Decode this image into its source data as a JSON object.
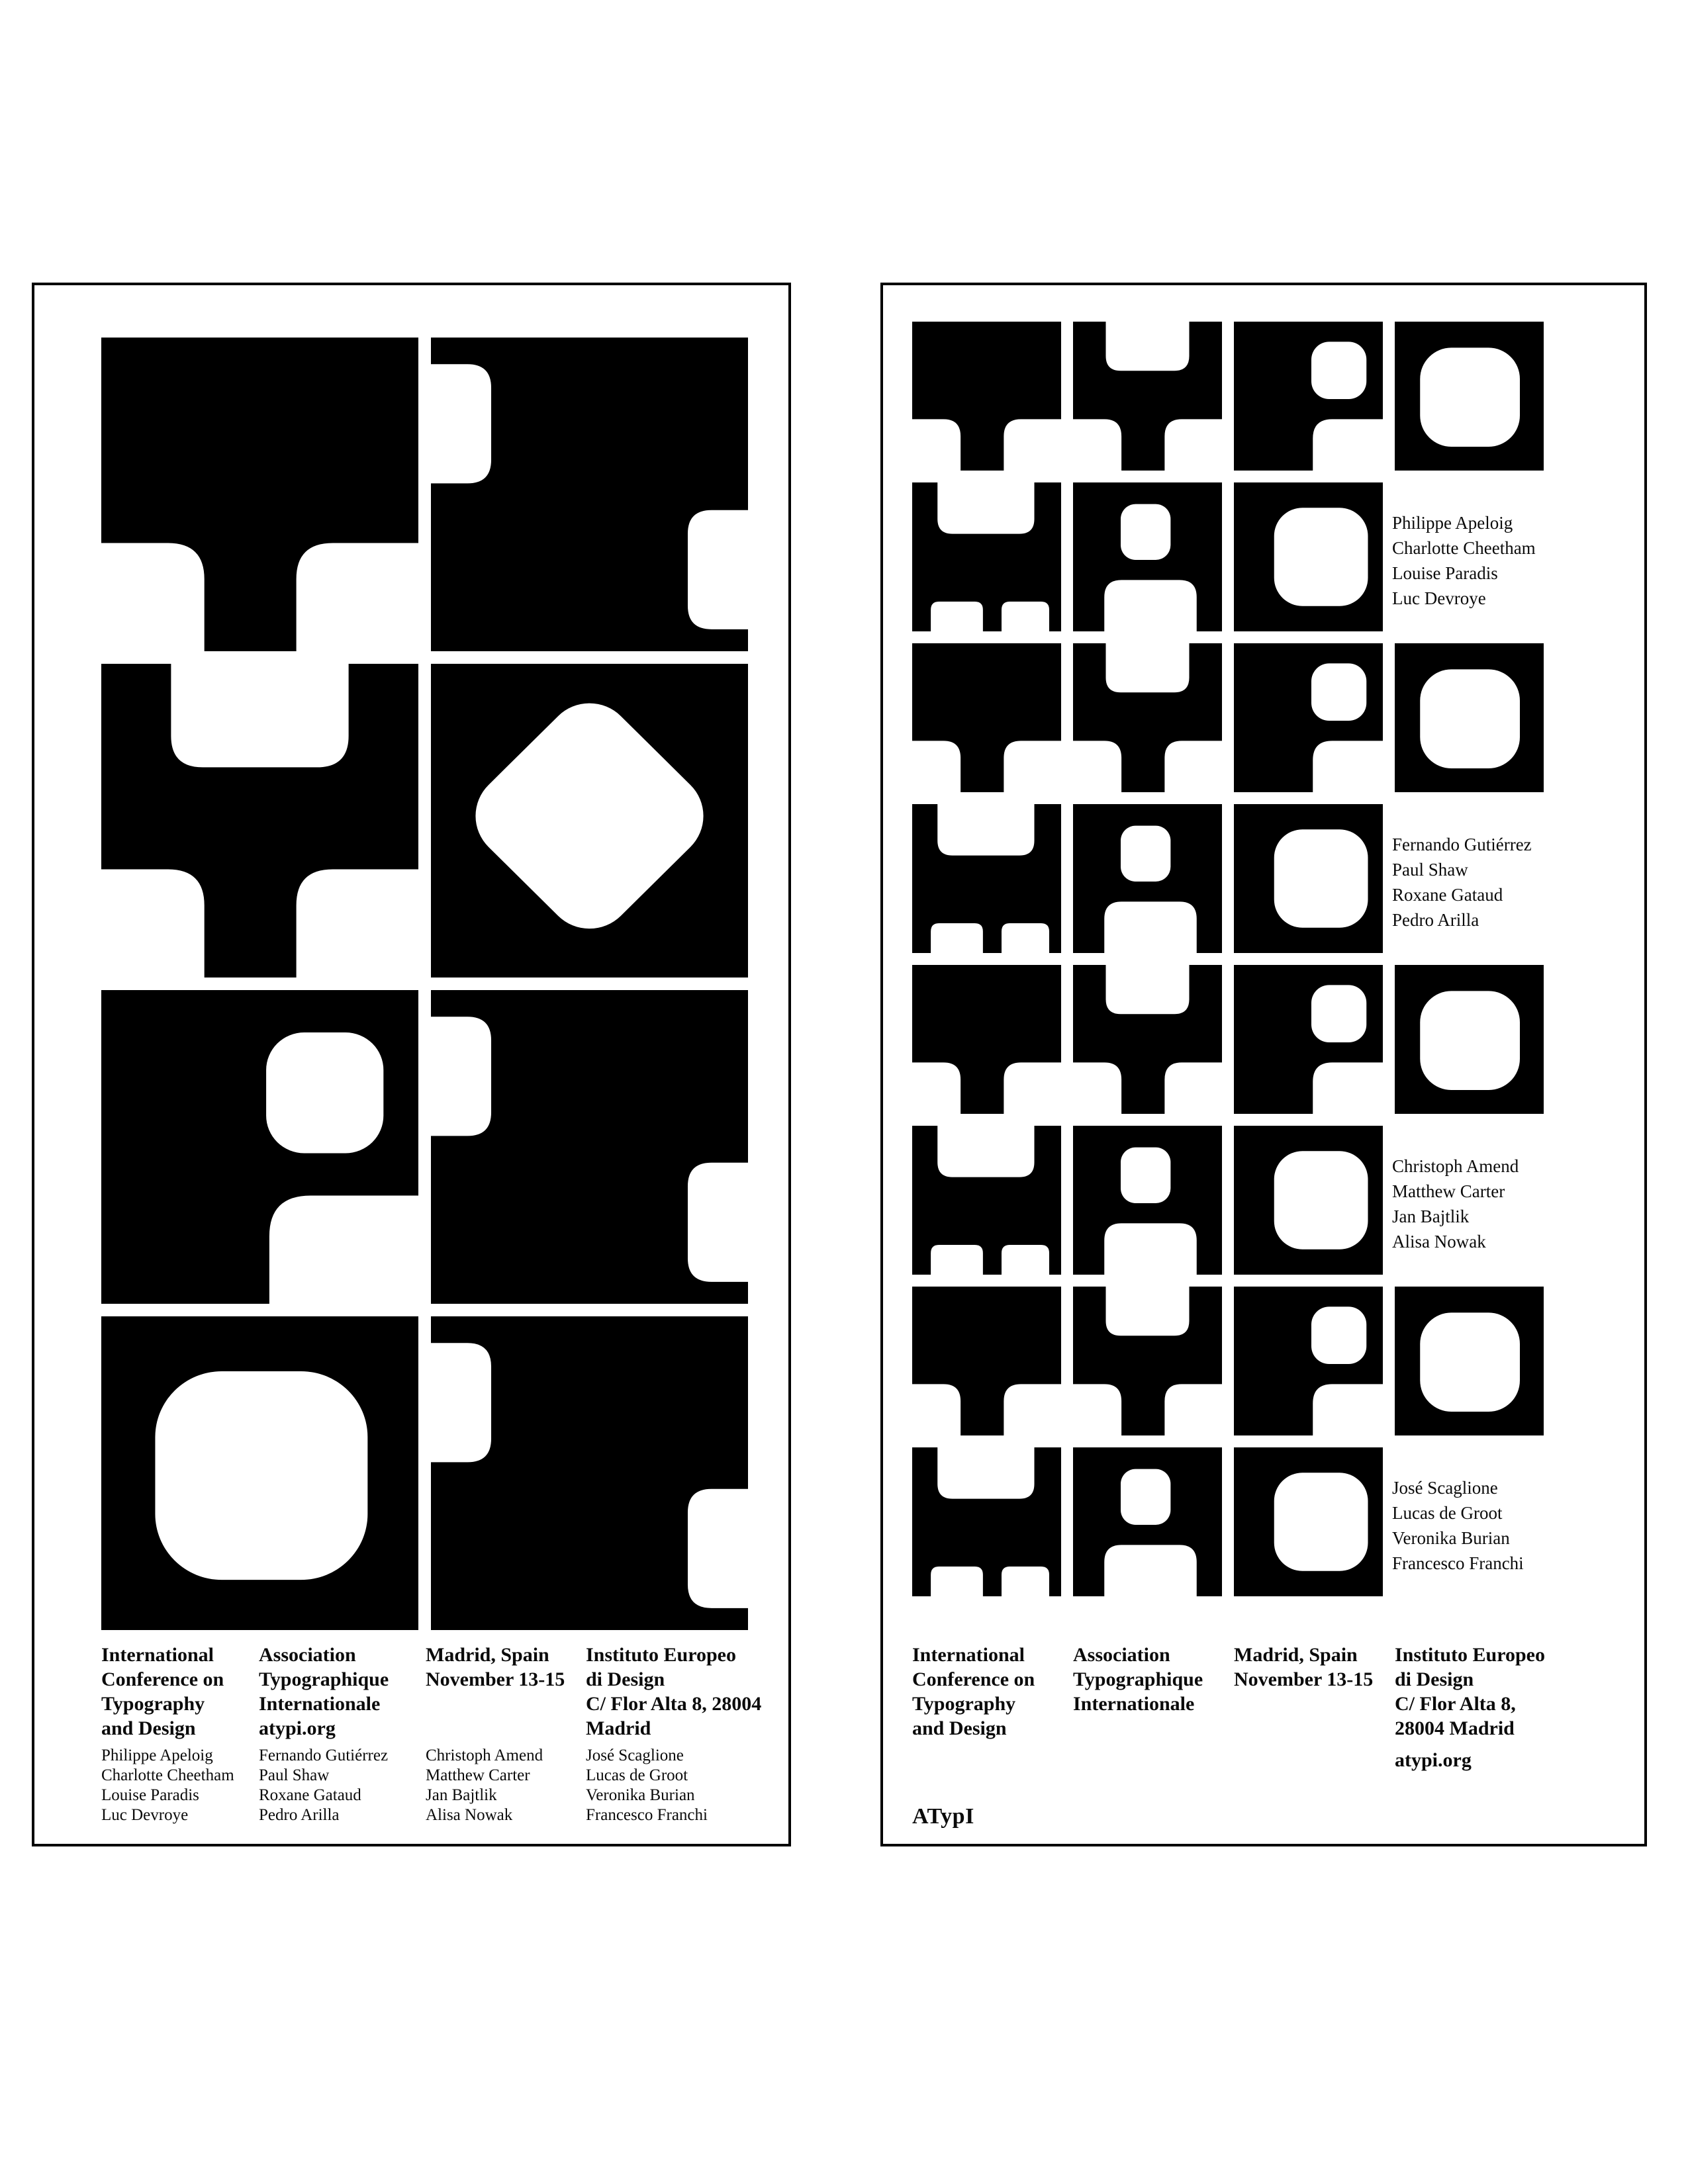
{
  "page": {
    "background": "#ffffff",
    "ink": "#000000"
  },
  "posters": {
    "left": {
      "name": "typo-letterform-poster-zoomed",
      "grid": [
        [
          "T",
          "EDGE"
        ],
        [
          "Y",
          "O_DIAMOND"
        ],
        [
          "P",
          "EDGE"
        ],
        [
          "O",
          "EDGE"
        ]
      ],
      "footer_columns": [
        {
          "heading_lines": [
            "International",
            "Conference on",
            "Typography",
            "and Design"
          ],
          "names": [
            "Philippe Apeloig",
            "Charlotte Cheetham",
            "Louise Paradis",
            "Luc Devroye"
          ]
        },
        {
          "heading_lines": [
            "Association",
            "Typographique",
            "Internationale",
            "atypi.org"
          ],
          "names": [
            "Fernando Gutiérrez",
            "Paul Shaw",
            "Roxane Gataud",
            "Pedro Arilla"
          ]
        },
        {
          "heading_lines": [
            "Madrid, Spain",
            "November 13-15"
          ],
          "names": [
            "Christoph Amend",
            "Matthew Carter",
            "Jan Bajtlik",
            "Alisa Nowak"
          ]
        },
        {
          "heading_lines": [
            "Instituto Europeo",
            "di Design",
            "C/ Flor Alta 8, 28004",
            "Madrid"
          ],
          "names": [
            "José Scaglione",
            "Lucas de Groot",
            "Veronika Burian",
            "Francesco Franchi"
          ]
        }
      ]
    },
    "right": {
      "name": "typo-mad-grid-poster",
      "rows": [
        {
          "tiles": [
            "T",
            "Y",
            "P",
            "O"
          ]
        },
        {
          "tiles": [
            "M",
            "A",
            "D"
          ],
          "names": [
            "Philippe Apeloig",
            "Charlotte Cheetham",
            "Louise Paradis",
            "Luc Devroye"
          ]
        },
        {
          "tiles": [
            "T",
            "Y",
            "P",
            "O"
          ]
        },
        {
          "tiles": [
            "M",
            "A",
            "D"
          ],
          "names": [
            "Fernando Gutiérrez",
            "Paul Shaw",
            "Roxane Gataud",
            "Pedro Arilla"
          ]
        },
        {
          "tiles": [
            "T",
            "Y",
            "P",
            "O"
          ]
        },
        {
          "tiles": [
            "M",
            "A",
            "D"
          ],
          "names": [
            "Christoph Amend",
            "Matthew Carter",
            "Jan Bajtlik",
            "Alisa Nowak"
          ]
        },
        {
          "tiles": [
            "T",
            "Y",
            "P",
            "O"
          ]
        },
        {
          "tiles": [
            "M",
            "A",
            "D"
          ],
          "names": [
            "José Scaglione",
            "Lucas de Groot",
            "Veronika Burian",
            "Francesco Franchi"
          ]
        }
      ],
      "footer_columns": [
        {
          "heading_lines": [
            "International",
            "Conference on",
            "Typography",
            "and Design"
          ]
        },
        {
          "heading_lines": [
            "Association",
            "Typographique",
            "Internationale"
          ]
        },
        {
          "heading_lines": [
            "Madrid, Spain",
            "November 13-15"
          ]
        },
        {
          "heading_lines": [
            "Instituto Europeo",
            "di Design",
            "C/ Flor Alta 8,",
            "28004 Madrid"
          ],
          "link": "atypi.org"
        }
      ],
      "logo": "ATypI"
    }
  }
}
